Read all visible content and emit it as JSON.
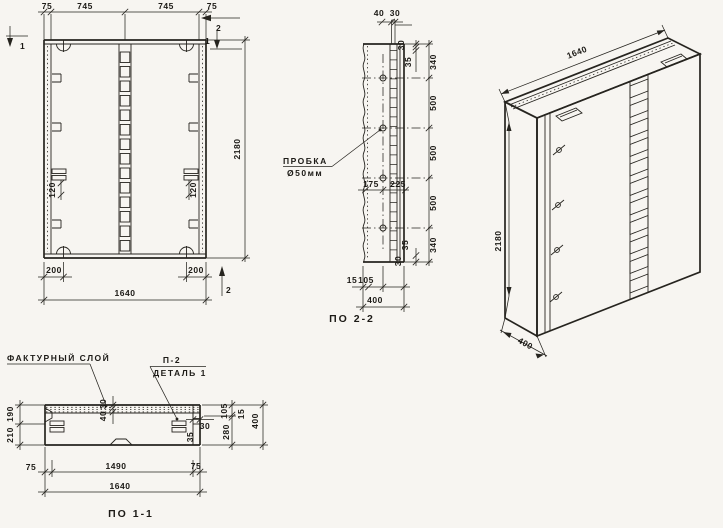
{
  "drawing": {
    "front": {
      "dim_75_left": "75",
      "dim_745_left": "745",
      "dim_745_right": "745",
      "dim_75_right": "75",
      "dim_height": "2180",
      "dim_120_left": "120",
      "dim_120_right": "120",
      "dim_200_left": "200",
      "dim_200_right": "200",
      "dim_width": "1640",
      "mark_1_top": "1",
      "mark_2_top": "2",
      "mark_1_right": "1",
      "mark_2_bottom": "2"
    },
    "section2": {
      "caption": "ПО 2-2",
      "plug_label_line1": "ПРОБКА",
      "plug_label_line2": "Ø50мм",
      "dim_top_40": "40",
      "dim_top_30": "30",
      "col_30_top": "30",
      "col_35_top": "35",
      "col_340_top": "340",
      "col_500_a": "500",
      "col_500_b": "500",
      "col_500_c": "500",
      "col_340_bot": "340",
      "col_35_bot": "35",
      "col_30_bot": "30",
      "dim_mid_175": "175",
      "dim_mid_225": "225",
      "dim_bot_15": "15",
      "dim_bot_105": "105",
      "dim_bot_400": "400"
    },
    "iso": {
      "dim_width": "1640",
      "dim_height": "2180",
      "dim_depth": "400"
    },
    "section1": {
      "caption": "ПО 1-1",
      "label_facture": "ФАКТУРНЫЙ СЛОЙ",
      "label_p2": "П-2",
      "label_detail": "ДЕТАЛЬ 1",
      "dim_190": "190",
      "dim_210": "210",
      "dim_30_mid": "30",
      "dim_40_mid": "40",
      "dim_30_right": "30",
      "dim_35_right": "35",
      "dim_105": "105",
      "dim_15": "15",
      "dim_280": "280",
      "dim_400": "400",
      "dim_75_left": "75",
      "dim_1490": "1490",
      "dim_75_right": "75",
      "dim_1640": "1640"
    },
    "colors": {
      "ink": "#26241f",
      "paper": "#f7f5f1"
    }
  }
}
